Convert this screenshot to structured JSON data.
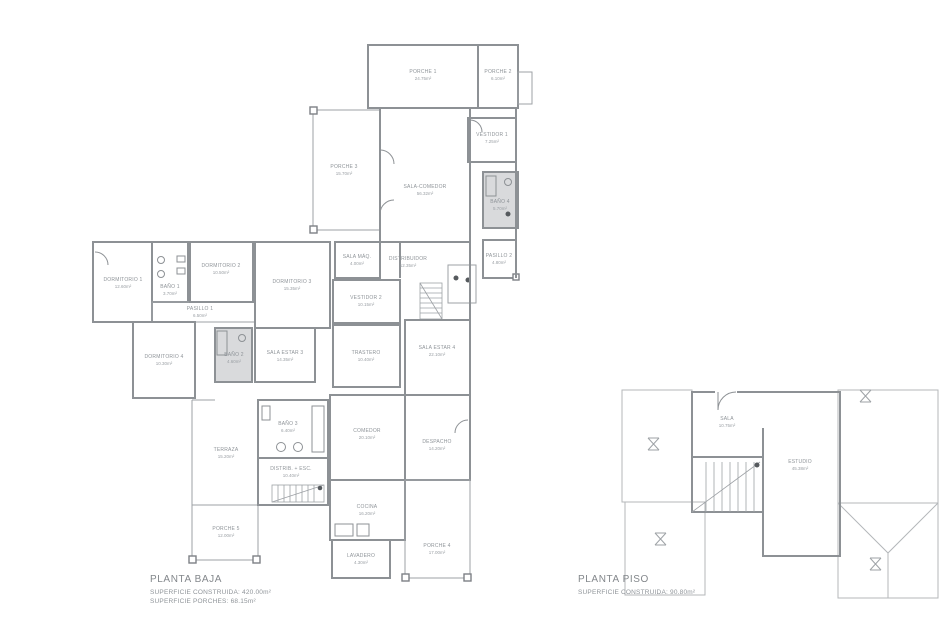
{
  "baja": {
    "title": "PLANTA BAJA",
    "line1": "SUPERFICIE CONSTRUIDA: 420.00m²",
    "line2": "SUPERFICIE PORCHES: 68.15m²",
    "rooms": {
      "porche1": {
        "name": "PORCHE 1",
        "area": "24.75m²"
      },
      "porche2": {
        "name": "PORCHE 2",
        "area": "6.10m²"
      },
      "porche3": {
        "name": "PORCHE 3",
        "area": "15.70m²"
      },
      "salon": {
        "name": "SALA-COMEDOR",
        "area": "56.32m²"
      },
      "vestidor1": {
        "name": "VESTIDOR 1",
        "area": "7.25m²"
      },
      "bano4": {
        "name": "BAÑO 4",
        "area": "5.70m²"
      },
      "pasillo2": {
        "name": "PASILLO 2",
        "area": "4.80m²"
      },
      "dormitorio1": {
        "name": "DORMITORIO 1",
        "area": "12.60m²"
      },
      "bano1": {
        "name": "BAÑO 1",
        "area": "3.70m²"
      },
      "pasillo1": {
        "name": "PASILLO 1",
        "area": "6.50m²"
      },
      "dormitorio2": {
        "name": "DORMITORIO 2",
        "area": "10.50m²"
      },
      "dormitorio3": {
        "name": "DORMITORIO 3",
        "area": "15.35m²"
      },
      "salaMaquinas": {
        "name": "SALA MÁQ.",
        "area": "4.00m²"
      },
      "vestidor2": {
        "name": "VESTIDOR 2",
        "area": "10.15m²"
      },
      "trastero": {
        "name": "TRASTERO",
        "area": "10.40m²"
      },
      "distribuidor1": {
        "name": "DISTRIBUIDOR",
        "area": "12.35m²"
      },
      "dormitorio4": {
        "name": "DORMITORIO 4",
        "area": "10.30m²"
      },
      "bano2": {
        "name": "BAÑO 2",
        "area": "4.60m²"
      },
      "estar": {
        "name": "SALA ESTAR 3",
        "area": "14.35m²"
      },
      "salaEstar4": {
        "name": "SALA ESTAR 4",
        "area": "22.10m²"
      },
      "despacho": {
        "name": "DESPACHO",
        "area": "14.20m²"
      },
      "terraza": {
        "name": "TERRAZA",
        "area": "15.20m²"
      },
      "porche5": {
        "name": "PORCHE 5",
        "area": "12.00m²"
      },
      "bano3": {
        "name": "BAÑO 3",
        "area": "6.40m²"
      },
      "distribuidor2": {
        "name": "DISTRIB. + ESC.",
        "area": "10.40m²"
      },
      "comedor": {
        "name": "COMEDOR",
        "area": "20.10m²"
      },
      "cocina": {
        "name": "COCINA",
        "area": "16.20m²"
      },
      "lavadero": {
        "name": "LAVADERO",
        "area": "4.30m²"
      },
      "porche4": {
        "name": "PORCHE 4",
        "area": "17.00m²"
      }
    }
  },
  "piso": {
    "title": "PLANTA PISO",
    "line1": "SUPERFICIE CONSTRUIDA: 90.80m²",
    "rooms": {
      "sala": {
        "name": "SALA",
        "area": "10.75m²"
      },
      "estudio": {
        "name": "ESTUDIO",
        "area": "45.38m²"
      }
    }
  },
  "colors": {
    "wall": "#8d9195",
    "text": "#8f9499",
    "tile": "#d9dadc",
    "roof": "#b4b7ba",
    "background": "#ffffff"
  }
}
